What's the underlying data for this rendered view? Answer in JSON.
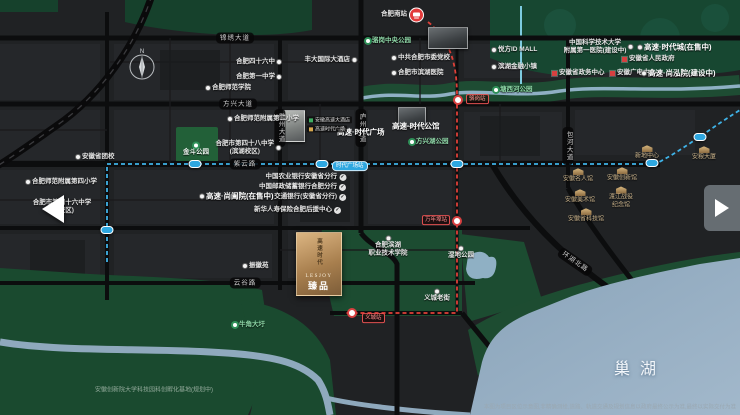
{
  "logo": {
    "vertical": "高速时代",
    "en": "LESJOY",
    "name": "臻品"
  },
  "map": {
    "labels": [
      {
        "type": "dot",
        "text": "合肥四十六中",
        "x": 281,
        "y": 62,
        "align": "r",
        "dot": "r"
      },
      {
        "type": "dot",
        "text": "合肥第一中学",
        "x": 281,
        "y": 77,
        "align": "r",
        "dot": "r"
      },
      {
        "type": "dot",
        "text": "丰大国际大酒店",
        "x": 356,
        "y": 60,
        "align": "r",
        "dot": "r"
      },
      {
        "type": "dot",
        "text": "合肥师范学院",
        "x": 206,
        "y": 88,
        "align": "l",
        "dot": "l"
      },
      {
        "type": "dot",
        "text": "合肥师范附属第二小学",
        "x": 228,
        "y": 119,
        "align": "l",
        "dot": "l"
      },
      {
        "type": "dot",
        "lines": [
          "合肥市第四十八中学",
          "(滨湖校区)"
        ],
        "x": 280,
        "y": 148,
        "align": "r",
        "dot": "r"
      },
      {
        "type": "dot",
        "text": "安徽省团校",
        "x": 76,
        "y": 157,
        "align": "l",
        "dot": "l"
      },
      {
        "type": "dot",
        "text": "合肥师范附属第四小学",
        "x": 26,
        "y": 182,
        "align": "l",
        "dot": "l"
      },
      {
        "type": "dot",
        "lines": [
          "合肥市第四十六中学",
          "(南校区)"
        ],
        "x": 62,
        "y": 207,
        "align": "c"
      },
      {
        "type": "dot",
        "text": "中共合肥市委党校",
        "x": 392,
        "y": 58,
        "align": "l",
        "dot": "l"
      },
      {
        "type": "dot",
        "text": "合肥市滨湖医院",
        "x": 392,
        "y": 73,
        "align": "l",
        "dot": "l"
      },
      {
        "type": "dot",
        "text": "悦方ID MALL",
        "x": 492,
        "y": 50,
        "align": "l",
        "dot": "l"
      },
      {
        "type": "dot",
        "text": "滨湖金融小镇",
        "x": 492,
        "y": 67,
        "align": "l",
        "dot": "l"
      },
      {
        "type": "dot",
        "lines": [
          "中国科学技术大学",
          "附属第一医院(建设中)"
        ],
        "x": 598,
        "y": 47,
        "align": "c",
        "dot": "r"
      },
      {
        "type": "dot",
        "text": "振徽苑",
        "x": 243,
        "y": 266,
        "align": "l",
        "dot": "l"
      },
      {
        "type": "dot",
        "lines": [
          "合肥滨湖",
          "职业技术学院"
        ],
        "x": 388,
        "y": 247,
        "align": "c",
        "dot": "t"
      },
      {
        "type": "dot",
        "text": "湿地公园",
        "x": 461,
        "y": 253,
        "align": "c",
        "dot": "t"
      },
      {
        "type": "dot",
        "text": "义城老街",
        "x": 437,
        "y": 296,
        "align": "c",
        "dot": "t"
      },
      {
        "type": "check",
        "text": "中国农业银行安徽省分行",
        "x": 346,
        "y": 177,
        "align": "r"
      },
      {
        "type": "check",
        "text": "中国邮政储蓄银行合肥分行",
        "x": 346,
        "y": 187,
        "align": "r"
      },
      {
        "type": "check",
        "text": "交通银行(安徽省分行)",
        "x": 346,
        "y": 197,
        "align": "r"
      },
      {
        "type": "check",
        "text": "新华人寿保险合肥后援中心",
        "x": 341,
        "y": 210,
        "align": "r"
      },
      {
        "type": "redsq",
        "text": "安徽省人民政府",
        "x": 622,
        "y": 59,
        "align": "l"
      },
      {
        "type": "redsq",
        "text": "安徽省政务中心",
        "x": 552,
        "y": 73,
        "align": "l"
      },
      {
        "type": "redsq",
        "text": "安徽广电中心",
        "x": 610,
        "y": 73,
        "align": "l"
      },
      {
        "type": "bold",
        "text": "高速·时代广场",
        "x": 337,
        "y": 132,
        "align": "l"
      },
      {
        "type": "bold",
        "text": "高速·时代公馆",
        "x": 392,
        "y": 126,
        "align": "l"
      },
      {
        "type": "bold",
        "text": "高速·尚阖院(在售中)",
        "x": 200,
        "y": 196,
        "align": "l",
        "dot": "l"
      },
      {
        "type": "bold",
        "text": "高速·时代城(在售中)",
        "x": 638,
        "y": 47,
        "align": "l",
        "dot": "l"
      },
      {
        "type": "bold",
        "text": "高速·尚泓院(建设中)",
        "x": 642,
        "y": 73,
        "align": "l",
        "dot": "l"
      },
      {
        "type": "green",
        "text": "骆岗中央公园",
        "x": 366,
        "y": 41,
        "align": "l",
        "dot": "l"
      },
      {
        "type": "green",
        "text": "塘西河公园",
        "x": 494,
        "y": 90,
        "align": "l",
        "dot": "l"
      },
      {
        "type": "green2",
        "text": "金斗公园",
        "x": 196,
        "y": 150,
        "align": "c",
        "dot": "t"
      },
      {
        "type": "green",
        "text": "方兴湖公园",
        "x": 410,
        "y": 142,
        "align": "l",
        "dot": "l"
      },
      {
        "type": "green",
        "text": "牛角大圩",
        "x": 233,
        "y": 325,
        "align": "l",
        "dot": "l"
      },
      {
        "type": "museum",
        "text": "安徽名人馆",
        "x": 578,
        "y": 176,
        "align": "c"
      },
      {
        "type": "museum",
        "text": "安徽创新馆",
        "x": 622,
        "y": 175,
        "align": "c"
      },
      {
        "type": "museum",
        "text": "安徽美术馆",
        "x": 580,
        "y": 197,
        "align": "c"
      },
      {
        "type": "museum",
        "lines": [
          "渡江战役",
          "纪念馆"
        ],
        "x": 621,
        "y": 198,
        "align": "c"
      },
      {
        "type": "museum",
        "text": "安徽省科技馆",
        "x": 586,
        "y": 216,
        "align": "c"
      },
      {
        "type": "museum",
        "text": "新地中心",
        "x": 647,
        "y": 153,
        "align": "c"
      },
      {
        "type": "museum",
        "text": "安粮大厦",
        "x": 704,
        "y": 154,
        "align": "c"
      },
      {
        "type": "roadh",
        "text": "锦绣大道",
        "x": 235,
        "y": 38,
        "align": "c"
      },
      {
        "type": "roadh",
        "text": "方兴大道",
        "x": 238,
        "y": 104,
        "align": "c"
      },
      {
        "type": "roadh",
        "text": "紫云路",
        "x": 245,
        "y": 164,
        "align": "c"
      },
      {
        "type": "roadh",
        "text": "云谷路",
        "x": 245,
        "y": 283,
        "align": "c"
      },
      {
        "type": "roadh",
        "text": "环湖北路",
        "x": 575,
        "y": 262,
        "align": "c",
        "rot": 35
      },
      {
        "type": "roadv",
        "text": "徽州大道",
        "x": 280,
        "y": 128,
        "align": "c"
      },
      {
        "type": "roadv",
        "text": "庐州大道",
        "x": 361,
        "y": 128,
        "align": "c"
      },
      {
        "type": "roadv",
        "text": "包河大道",
        "x": 568,
        "y": 146,
        "align": "c"
      },
      {
        "type": "stlb",
        "text": "时代广场站",
        "x": 332,
        "y": 166,
        "align": "l"
      },
      {
        "type": "strb",
        "text": "骆岗站",
        "x": 466,
        "y": 99,
        "align": "l"
      },
      {
        "type": "strb",
        "text": "万年埠站",
        "x": 450,
        "y": 220,
        "align": "r"
      },
      {
        "type": "strb",
        "text": "义城站",
        "x": 362,
        "y": 318,
        "align": "l"
      },
      {
        "type": "hsr",
        "text": "合肥南站",
        "x": 424,
        "y": 15,
        "align": "r"
      },
      {
        "type": "tagg",
        "text": "安徽高速大酒店",
        "x": 307,
        "y": 120,
        "align": "l"
      },
      {
        "type": "tago",
        "text": "高速时代广场",
        "x": 307,
        "y": 129,
        "align": "l"
      },
      {
        "type": "caption",
        "text": "安徽创新院大学科技园科创孵化基地(规划中)",
        "x": 95,
        "y": 391,
        "align": "l"
      },
      {
        "type": "caption2",
        "text": "本图为项目区位示意图,非精确测绘,道路、轨道交通及规划信息以政府最终公示为准,最终以实际交付为准",
        "x": 736,
        "y": 408,
        "align": "r"
      },
      {
        "type": "big",
        "text": "巢湖",
        "x": 640,
        "y": 370,
        "align": "c"
      }
    ],
    "stations_blue": [
      {
        "x": 107,
        "y": 230
      },
      {
        "x": 195,
        "y": 164
      },
      {
        "x": 322,
        "y": 164
      },
      {
        "x": 457,
        "y": 164
      },
      {
        "x": 652,
        "y": 163
      },
      {
        "x": 700,
        "y": 137
      }
    ],
    "stations_red": [
      {
        "x": 458,
        "y": 100
      },
      {
        "x": 457,
        "y": 221
      },
      {
        "x": 352,
        "y": 313
      }
    ],
    "photos": [
      {
        "x": 283,
        "y": 110,
        "w": 20,
        "h": 30,
        "kind": "light"
      },
      {
        "x": 428,
        "y": 27,
        "w": 38,
        "h": 20,
        "kind": "dark"
      },
      {
        "x": 398,
        "y": 107,
        "w": 26,
        "h": 18,
        "kind": "dark"
      }
    ],
    "compass_letter": "N"
  }
}
